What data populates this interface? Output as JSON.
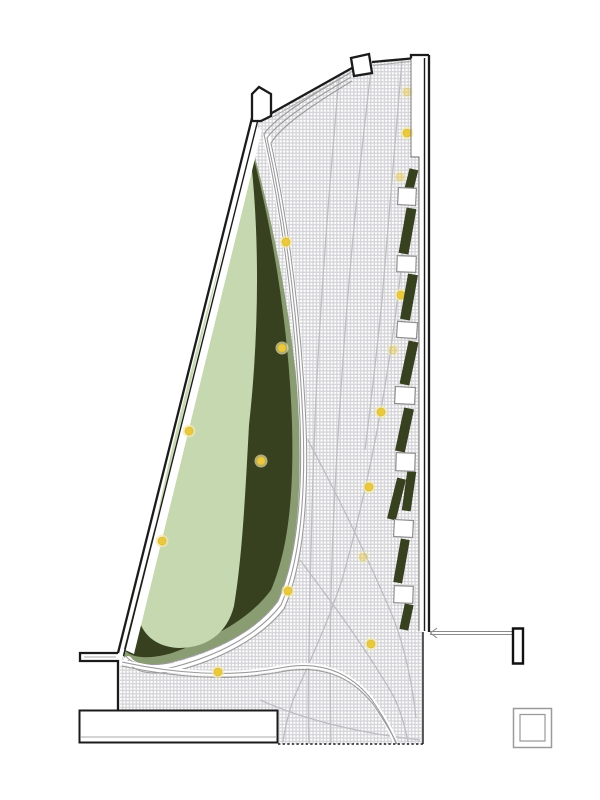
{
  "canvas": {
    "width": 600,
    "height": 800,
    "background": "#ffffff"
  },
  "palette": {
    "wall": "#1b1b1b",
    "dark_green": "#37411f",
    "mid_green": "#8a9c72",
    "light_green": "#c6d8af",
    "tree_fill": "#eac93e",
    "tree_halo": "#f6eaa6",
    "path_line": "#9b9b9b",
    "faint_path": "#bdbdc2",
    "hatch_bg": "#d4d4d8",
    "hatch_dot": "#ffffff",
    "deck_stroke": "#8f8f8f"
  },
  "shapes": {
    "hatch_region": "M258,123 L270,114 L352,68 L372,62 L411,58 L411,157 L419,157 L419,632 L423,632 L423,744 L277,744 L277,710 L120,710 L120,661 L124,655 Z",
    "sage_blob": "M252,146 C280,248 298,356 301,448 C303,512 295,566 276,604 C252,634 212,652 170,663 C145,669 127,666 123,655 Z",
    "dark_blob": "M251,147 C274,236 289,330 292,424 C294,496 288,550 271,590 C249,620 211,639 172,653 C148,660 130,658 124,649 Z",
    "light_blob": "M250,152 C260,235 259,335 249,425 C245,500 242,558 234,606 C227,634 206,648 179,648 C157,647 144,636 139,620 C160,468 216,278 250,152 Z",
    "left_wedge": "M251,148 C229,242 207,332 189,428 C205,353 229,252 249,165 Z",
    "wall_gap_band": "M254,126 L262,130 L134,654 L125,650 Z",
    "bundle_under": "M267,138 C285,218 298,313 303,422 C306,502 299,564 281,605 C257,636 216,656 174,667 C152,671 134,669 128,660",
    "bundle_1": "M350,73 C310,96 276,117 264,134 C282,215 295,310 300,420 C303,500 296,560 278,601 C255,632 215,651 172,662 C150,667 132,665 126,656",
    "bundle_2": "M351,77 C312,100 279,121 267,138 C285,218 298,313 303,422 C306,502 299,564 281,605 C257,636 216,656 174,667 C152,671 134,669 128,660",
    "bundle_3": "M352,81 C314,104 282,125 271,143 C288,221 301,316 306,424 C309,504 302,568 284,609 C259,640 218,660 176,671 C154,675 136,673 130,664",
    "secondary_1": "M122,662 C170,673 230,678 280,668 C320,660 350,672 372,700 C384,718 392,732 396,744",
    "secondary_2": "M122,666 C170,677 230,682 280,672 C320,664 351,676 373,704 C385,722 393,735 397,744"
  },
  "site_paths": [
    "M340,66 C330,180 320,300 315,420 C312,500 310,580 309,650 C308,690 308,720 309,744",
    "M372,62 C360,160 350,260 343,360 C338,430 334,500 332,560 C330,620 330,690 331,744",
    "M402,60 C395,140 388,220 382,300 C377,350 371,402 365,450",
    "M297,420 C330,480 360,540 390,610 C403,640 412,680 416,718",
    "M300,560 C330,600 360,640 390,690 C398,703 404,722 408,742",
    "M260,700 C300,718 350,732 420,740",
    "M403,250 C392,360 373,470 342,580 C327,625 308,665 293,700 C289,712 285,728 283,742"
  ],
  "trees": {
    "bright": [
      [
        286,
        242
      ],
      [
        282,
        348
      ],
      [
        407,
        133
      ],
      [
        401,
        295
      ],
      [
        381,
        412
      ],
      [
        369,
        487
      ],
      [
        261,
        461
      ],
      [
        189,
        431
      ],
      [
        162,
        541
      ],
      [
        288,
        591
      ],
      [
        371,
        644
      ],
      [
        218,
        672
      ]
    ],
    "pale": [
      [
        407,
        92
      ],
      [
        400,
        177
      ],
      [
        393,
        350
      ],
      [
        363,
        557
      ]
    ]
  },
  "planters": {
    "bars": [
      {
        "cx": 411.5,
        "cy": 179,
        "w": 9,
        "h": 20,
        "r": 14
      },
      {
        "cx": 407.5,
        "cy": 231,
        "w": 10,
        "h": 46,
        "r": 10
      },
      {
        "cx": 409,
        "cy": 297,
        "w": 10,
        "h": 46,
        "r": 10
      },
      {
        "cx": 409,
        "cy": 363,
        "w": 10,
        "h": 44,
        "r": 12
      },
      {
        "cx": 404.5,
        "cy": 430,
        "w": 10,
        "h": 44,
        "r": 12
      },
      {
        "cx": 396.5,
        "cy": 499,
        "w": 9,
        "h": 42,
        "r": 14
      },
      {
        "cx": 409,
        "cy": 491,
        "w": 9,
        "h": 40,
        "r": 8
      },
      {
        "cx": 401.5,
        "cy": 561,
        "w": 9,
        "h": 44,
        "r": 10
      },
      {
        "cx": 406.5,
        "cy": 617,
        "w": 9,
        "h": 26,
        "r": 12
      }
    ],
    "decks": [
      {
        "cx": 407,
        "cy": 196.5,
        "w": 18,
        "h": 17,
        "r": 3
      },
      {
        "cx": 406.5,
        "cy": 264,
        "w": 19,
        "h": 16,
        "r": 2
      },
      {
        "cx": 407,
        "cy": 330,
        "w": 20,
        "h": 16,
        "r": 4
      },
      {
        "cx": 405,
        "cy": 395.5,
        "w": 20,
        "h": 17,
        "r": 3
      },
      {
        "cx": 405.5,
        "cy": 462,
        "w": 19,
        "h": 18,
        "r": 2
      },
      {
        "cx": 403.5,
        "cy": 528.5,
        "w": 19,
        "h": 17,
        "r": 3
      },
      {
        "cx": 403.5,
        "cy": 594.5,
        "w": 19,
        "h": 17,
        "r": 2
      }
    ]
  },
  "walls": {
    "top_edge": "M270,114 L352,68",
    "top_edge_inner": "M272,117.5 L352,71.5",
    "top_edge_b": "M372,62 L411,58.5",
    "top_edge_b_inner": "M373,65.5 L411,61.5",
    "right_corner": "M411,58.5 L411,55 L429,55",
    "right_outer": "M429,55 L429,632",
    "right_inner": "M424.5,58 L424.5,631",
    "hatch_step": "M411,59 L411,157 L419,157 L419,631",
    "left_outer": "M252,118 L118,653",
    "left_inner": "M257.5,121.5 L123.5,656",
    "ledge": "M118,653 L80,653 L80,661 L118,661 L118,710",
    "ledge_inner": "M116,657 L84,657",
    "bottom_right_edge": "M423,632 L423,744",
    "bottom_dashed": "M423,744 L277,744",
    "apex_notch": "M252,121 L252,94 L259,87 L271,94 L271,116 L261,121 Z",
    "notch2": "M351,58 L369,54 L372,73 L354,76 Z",
    "annex": "M79.5,710.5 L277.5,710.5 L277.5,742.5 L79.5,742.5 Z",
    "annex_inner": "M81,737 L276,737",
    "connector_a": "M430,631.5 L514,631.5",
    "connector_b": "M430,634.5 L514,634.5",
    "connector_arrow": "M437,628 L430.5,633 L437,638",
    "door_marker": "M513,628.5 L523,628.5 L523,663.5 L513,663.5 Z",
    "column_outer": "M513.5,708.5 L551.5,708.5 L551.5,747.5 L513.5,747.5 Z",
    "column_inner": "M520,714.5 L545,714.5 L545,741 L520,741 Z"
  }
}
